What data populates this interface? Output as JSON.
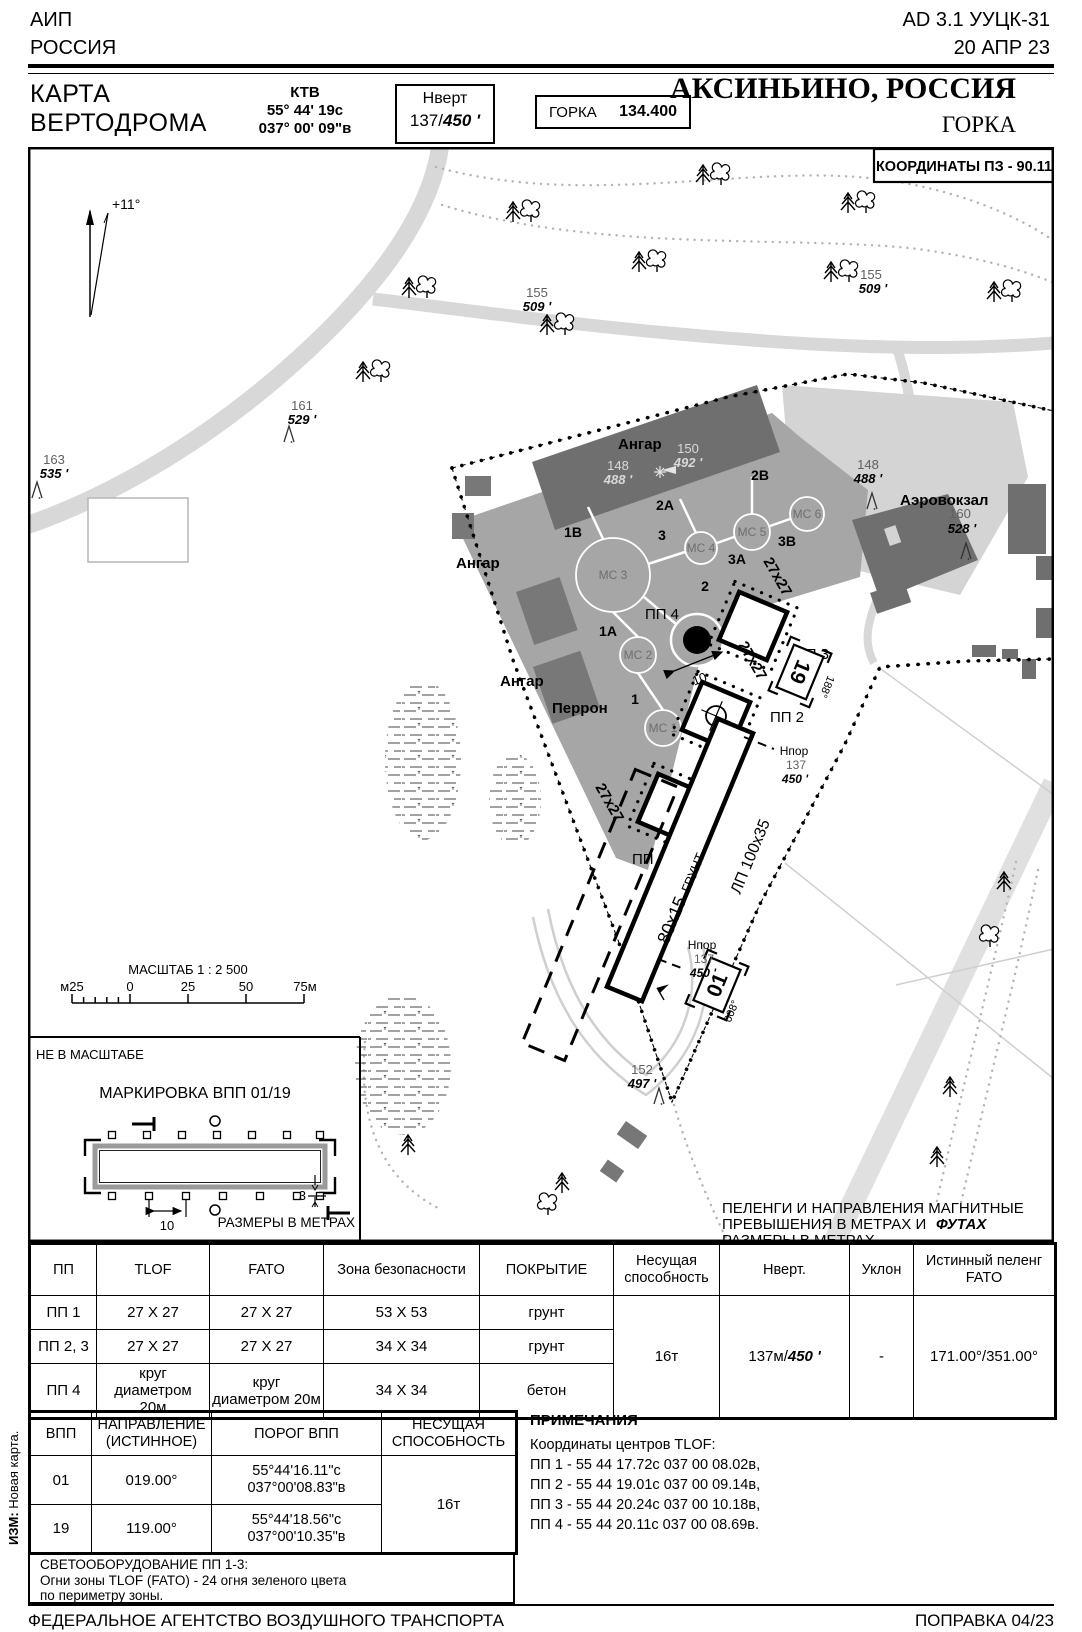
{
  "header": {
    "aip_line1": "АИП",
    "aip_line2": "РОССИЯ",
    "doc_ref": "AD 3.1 УУЦК-31",
    "date": "20 АПР 23",
    "title_line1": "КАРТА",
    "title_line2": "ВЕРТОДРОМА",
    "ktv_label": "КТВ",
    "ktv_lat": "55° 44' 19с",
    "ktv_lon": "037° 00' 09\"в",
    "nvert_label": "Нверт",
    "nvert_m": "137/",
    "nvert_ft": "450 '",
    "freq_label": "ГОРКА",
    "freq_value": "134.400",
    "city": "АКСИНЬИНО, РОССИЯ",
    "site": "ГОРКА"
  },
  "map": {
    "coords_box": "КООРДИНАТЫ ПЗ - 90.11",
    "declination": "+11°",
    "scalebar": {
      "title": "МАСШТАБ 1 : 2 500",
      "m25": "м25",
      "z": "0",
      "v25": "25",
      "v50": "50",
      "v75": "75м"
    },
    "labels": {
      "hangar": "Ангар",
      "apron": "Перрон",
      "terminal": "Аэровокзал",
      "mc1": "МС 1",
      "mc2": "МС 2",
      "mc3": "МС 3",
      "mc4": "МС 4",
      "mc5": "МС 5",
      "mc6": "МС 6",
      "tw1": "1",
      "tw1a": "1А",
      "tw1b": "1В",
      "tw2": "2",
      "tw2a": "2А",
      "tw2b": "2В",
      "tw3": "3",
      "tw3a": "3А",
      "tw3b": "3В",
      "pp1": "ПП 1",
      "pp2": "ПП 2",
      "pp3": "ПП 3",
      "pp4": "ПП 4",
      "dim27": "27х27",
      "dim10": "10",
      "h": "H",
      "lp": "ЛП 100х35",
      "strip_a": "80х15",
      "strip_b": "ГРУНТ",
      "thr01": "01",
      "brg01": "008°",
      "thr19": "19",
      "brg19": "188°",
      "npor_t": "Нпор",
      "npor_m": "137",
      "npor_f": "450 '"
    },
    "elev": {
      "e163": {
        "m": "163",
        "f": "535 '"
      },
      "e161": {
        "m": "161",
        "f": "529 '"
      },
      "e155": {
        "m": "155",
        "f": "509 '"
      },
      "e152": {
        "m": "152",
        "f": "497 '"
      },
      "e148": {
        "m": "148",
        "f": "488 '"
      },
      "e150": {
        "m": "150",
        "f": "492 '"
      },
      "e160": {
        "m": "160",
        "f": "528 '"
      }
    },
    "inset": {
      "nts": "НЕ В МАСШТАБЕ",
      "title": "МАРКИРОВКА ВПП 01/19",
      "d10": "10",
      "d3": "3",
      "caption": "РАЗМЕРЫ В МЕТРАХ"
    },
    "note": {
      "l1": "ПЕЛЕНГИ И НАПРАВЛЕНИЯ МАГНИТНЫЕ",
      "l2a": "ПРЕВЫШЕНИЯ В МЕТРАХ И",
      "l2b": "ФУТАХ",
      "l3": "РАЗМЕРЫ В МЕТРАХ"
    }
  },
  "table1": {
    "headers": [
      "ПП",
      "TLOF",
      "FATO",
      "Зона безопасности",
      "ПОКРЫТИЕ",
      "Несущая способность",
      "Нверт.",
      "Уклон",
      "Истинный пеленг FATO"
    ],
    "rows": [
      [
        "ПП 1",
        "27 X 27",
        "27 X 27",
        "53 X 53",
        "грунт"
      ],
      [
        "ПП 2, 3",
        "27 X 27",
        "27 X 27",
        "34 X 34",
        "грунт"
      ],
      [
        "ПП 4",
        "круг диаметром 20м",
        "круг диаметром 20м",
        "34 X 34",
        "бетон"
      ]
    ],
    "capacity": "16т",
    "nvert_m": "137м/",
    "nvert_ft": "450 '",
    "slope": "-",
    "bearing": "171.00°/351.00°"
  },
  "table2": {
    "headers": [
      "ВПП",
      "НАПРАВЛЕНИЕ (ИСТИННОЕ)",
      "ПОРОГ ВПП",
      "НЕСУЩАЯ СПОСОБНОСТЬ"
    ],
    "rows": [
      {
        "num": "01",
        "dir": "019.00°",
        "lat": "55°44'16.11\"с",
        "lon": "037°00'08.83\"в"
      },
      {
        "num": "19",
        "dir": "119.00°",
        "lat": "55°44'18.56\"с",
        "lon": "037°00'10.35\"в"
      }
    ],
    "capacity": "16т"
  },
  "lighting": {
    "l1": "СВЕТООБОРУДОВАНИЕ ПП 1-3:",
    "l2": "Огни зоны TLOF (FATO) - 24 огня зеленого цвета",
    "l3": "по периметру зоны."
  },
  "notes": {
    "title": "ПРИМЕЧАНИЯ",
    "subtitle": "Координаты центров TLOF:",
    "items": [
      "ПП 1 - 55 44 17.72с 037 00 08.02в,",
      "ПП 2 - 55 44 19.01с 037 00 09.14в,",
      "ПП 3 - 55 44 20.24с 037 00 10.18в,",
      "ПП 4 - 55 44 20.11с 037 00 08.69в."
    ]
  },
  "footer": {
    "left": "ФЕДЕРАЛЬНОЕ АГЕНТСТВО ВОЗДУШНОГО ТРАНСПОРТА",
    "right": "ПОПРАВКА 04/23"
  },
  "revision": {
    "label": "ИЗМ:",
    "text": "Новая карта."
  }
}
